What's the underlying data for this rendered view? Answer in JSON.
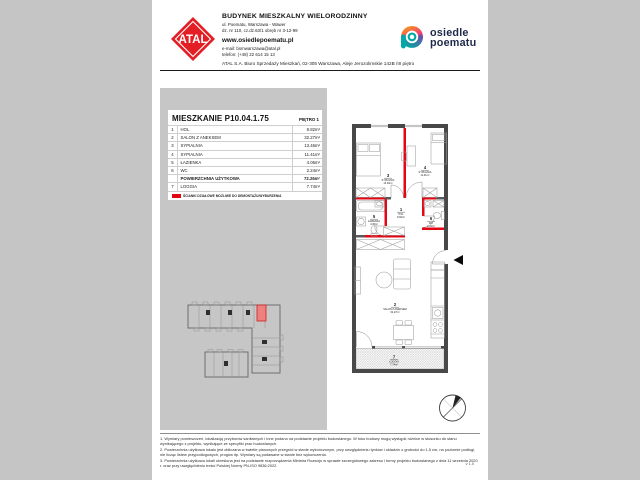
{
  "page": {
    "version": "v 1.0"
  },
  "header": {
    "logo": "ATAL",
    "title": "BUDYNEK MIESZKALNY WIELORODZINNY",
    "address1": "ul. Poematu, Warszawa - Wawer",
    "address2": "dz. nr 110, cz.dz.63/1 obręb nr 3-12-99",
    "website": "www.osiedlepoematu.pl",
    "email": "e-mail: bsmwarszawa@atal.pl",
    "phone": "telefon: (+48) 22 614 15 13",
    "office": "ATAL S.A. Biuro Sprzedaży Mieszkań, 02-305 Warszawa, Aleje Jerozolimskie 142B /III piętro",
    "brand_line1": "osiedle",
    "brand_line2": "poematu"
  },
  "apartment": {
    "title": "MIESZKANIE P10.04.1.75",
    "floor": "PIĘTRO 1",
    "rooms": [
      {
        "no": "1",
        "name": "HOL",
        "area": "8.82m²"
      },
      {
        "no": "2",
        "name": "SALON Z ANEKSEM",
        "area": "32.27m²"
      },
      {
        "no": "3",
        "name": "SYPIALNIA",
        "area": "13.46m²"
      },
      {
        "no": "4",
        "name": "SYPIALNIA",
        "area": "11.41m²"
      },
      {
        "no": "5",
        "name": "ŁAZIENKA",
        "area": "4.06m²"
      },
      {
        "no": "6",
        "name": "WC",
        "area": "2.24m²"
      }
    ],
    "total_label": "POWIERZCHNIA UŻYTKOWA",
    "total_area": "72.26m²",
    "loggia": {
      "no": "7",
      "name": "LOGGIA",
      "area": "7.74m²"
    },
    "legend": "ŚCIANKI DZIAŁOWE MOŻLIWE DO DEMONTAŻU/WYBURZENIA"
  },
  "plan": {
    "labels": [
      {
        "no": "1",
        "name": "HOL",
        "area": "8.82m²"
      },
      {
        "no": "2",
        "name": "SALON Z ANEKSEM",
        "area": "32.27m²"
      },
      {
        "no": "3",
        "name": "SYPIALNIA",
        "area": "13.46m²"
      },
      {
        "no": "4",
        "name": "SYPIALNIA",
        "area": "11.41m²"
      },
      {
        "no": "5",
        "name": "ŁAZIENKA",
        "area": "4.06m²"
      },
      {
        "no": "6",
        "name": "WC",
        "area": "2.24m²"
      },
      {
        "no": "7",
        "name": "LOGGIA",
        "area": "7.74m²"
      }
    ]
  },
  "footnotes": [
    "1. Wymiary pomieszczeń, lokalizację przyborów sanitarnych i inne podano na podstawie projektu budowlanego. W toku budowy mogą wystąpić różnice w stosunku do stanu wynikającego z projektu, wynikające ze specyfiki prac budowlanych.",
    "2. Powierzchnia użytkowa lokalu jest obliczana w świetle planowych przegród w stanie wykończonym, przy uwzględnieniu tynków i okładzin o grubości do 1,5 cm, na poziomie podłogi, nie licząc listew przypodłogowych, progów itp. Wymiary są podawane w stanie bez wykończenia.",
    "3. Powierzchnia użytkowa lokali określona jest na podstawie rozporządzenia Ministra Rozwoju w sprawie szczegółowego zakresu i formy projektu budowlanego z dnia 11 września 2020 r. oraz przy uwzględnieniu treści Polskiej Normy PN-ISO 9836:2022."
  ],
  "colors": {
    "accent_red": "#e30613",
    "brand_navy": "#1e2a4a",
    "wall_gray": "#484848"
  }
}
